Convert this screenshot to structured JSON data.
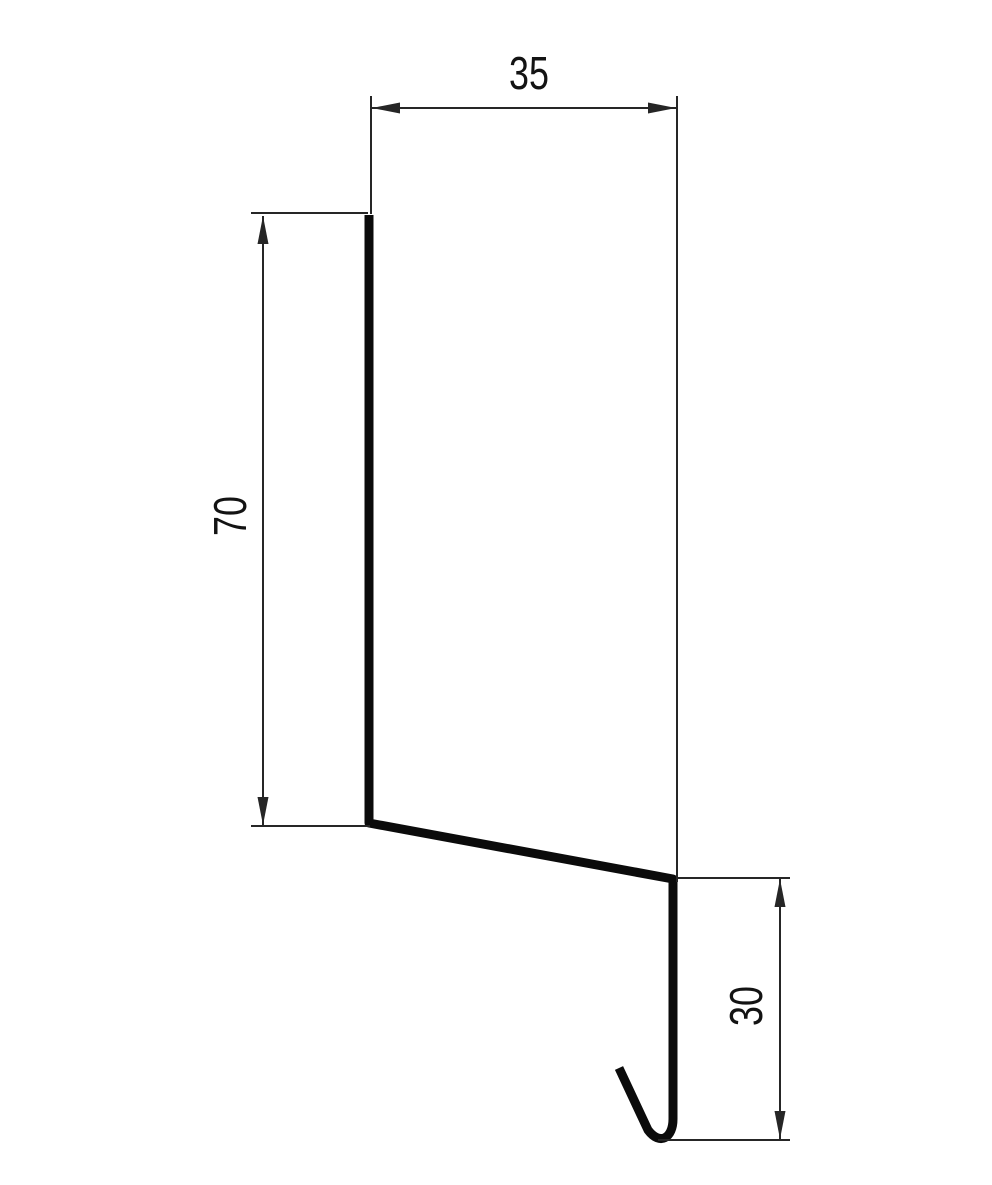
{
  "drawing": {
    "dimensions": {
      "top_width": "35",
      "left_height": "70",
      "right_height": "30"
    },
    "colors": {
      "background": "#ffffff",
      "profile": "#0b0b0b",
      "dimension": "#262626",
      "text": "#131313"
    }
  }
}
